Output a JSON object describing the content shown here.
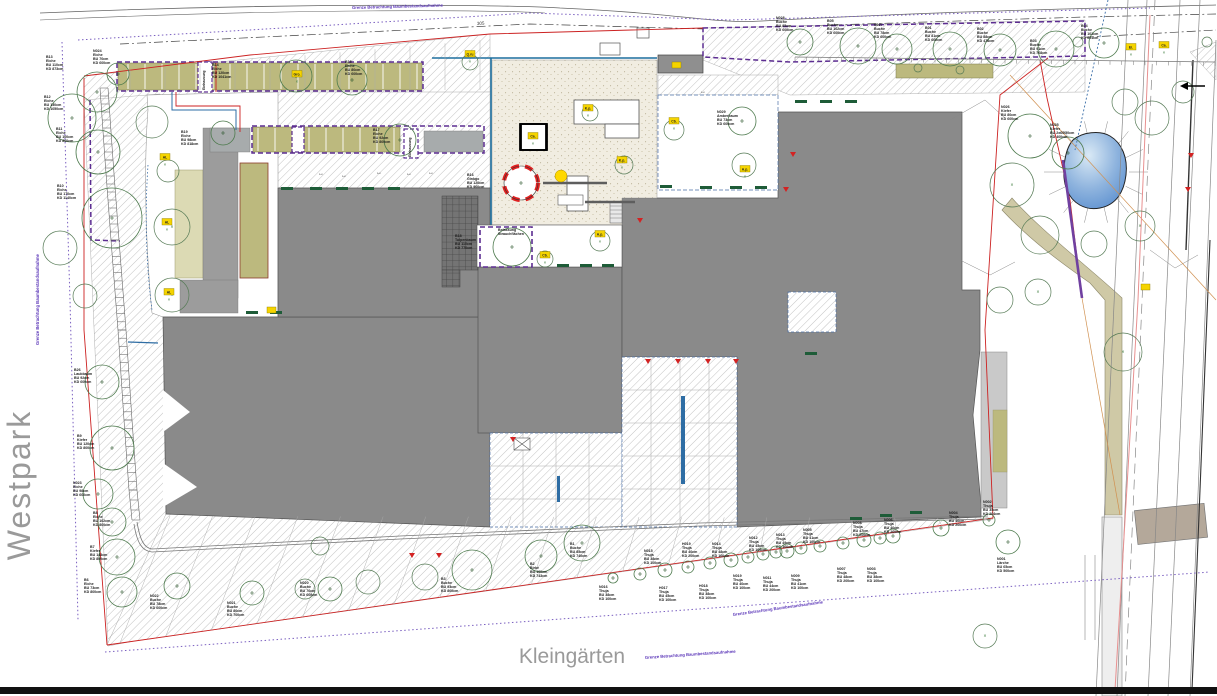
{
  "map_labels": {
    "westpark": "Westpark",
    "kleingaerten": "Kleingärten",
    "station_label": "305"
  },
  "boundary_notes": [
    {
      "text": "Grenze Betrachtung Baumbestandsaufnahme",
      "x": 352,
      "y": 9,
      "rot": -1.5
    },
    {
      "text": "Grenze Betrachtung Baumbestandsaufnahme",
      "x": 645,
      "y": 659,
      "rot": -4
    },
    {
      "text": "Grenze Betrachtung Baumbestandsaufnahme",
      "x": 733,
      "y": 616,
      "rot": -8
    },
    {
      "text": "Grenze Betrachtung Baumbestandsaufnahme",
      "x": 39,
      "y": 345,
      "rot": -90
    }
  ],
  "area_labels": [
    {
      "lines": [
        "Belassung",
        "Strauchflächen"
      ],
      "x": 498,
      "y": 230
    },
    {
      "lines": [
        "Einhausung"
      ],
      "x": 205,
      "y": 90,
      "vertical": true
    },
    {
      "lines": [
        "Einhausung"
      ],
      "x": 411,
      "y": 157,
      "vertical": true
    }
  ],
  "colors": {
    "building": "#8a8a8a",
    "building_light": "#c9c9c9",
    "planting": "#bcb97e",
    "planting_pale": "#dcdab4",
    "playground": "#f1ede1",
    "pond_light": "#cfe3f2",
    "pond_dark": "#5b8fcf",
    "boundary_purple": "#5c2d91",
    "boundary_red": "#cc2222",
    "tree_green": "#4d7a4d",
    "marker_yellow": "#f5d400",
    "path_beige": "#cfc9a6",
    "bar_green": "#1e5c38"
  },
  "trees": [
    {
      "id": "B13",
      "sp": "Eiche",
      "d1": "BU 110cm",
      "d2": "KD 873cm",
      "c": [
        97,
        92,
        20
      ],
      "l": [
        46,
        58
      ]
    },
    {
      "id": "N024",
      "sp": "Eiche",
      "d1": "BU 70cm",
      "d2": "KD 600cm",
      "c": [
        118,
        74,
        11
      ],
      "l": [
        93,
        52
      ]
    },
    {
      "id": "B12",
      "sp": "Eiche",
      "d1": "BU 130cm",
      "d2": "KD 1050cm",
      "c": [
        72,
        118,
        24
      ],
      "l": [
        44,
        98
      ]
    },
    {
      "id": "B11",
      "sp": "Eiche",
      "d1": "BU 100cm",
      "d2": "KD 800cm",
      "c": [
        98,
        152,
        22
      ],
      "l": [
        56,
        130
      ]
    },
    {
      "id": "B10",
      "sp": "Eiche",
      "d1": "BU 170cm",
      "d2": "KD 1140cm",
      "c": [
        112,
        218,
        30
      ],
      "l": [
        57,
        187
      ]
    },
    {
      "id": "B26",
      "sp": "Laubbaum",
      "d1": "BU 92cm",
      "d2": "KD 600cm",
      "c": [
        102,
        382,
        17
      ],
      "l": [
        74,
        371
      ]
    },
    {
      "id": "B9",
      "sp": "Kiefer",
      "d1": "BU 120cm",
      "d2": "KD 800cm",
      "c": [
        112,
        448,
        22
      ],
      "l": [
        77,
        437
      ]
    },
    {
      "id": "N023",
      "sp": "Eiche",
      "d1": "BU 98cm",
      "d2": "KD 600cm",
      "c": [
        98,
        494,
        15
      ],
      "l": [
        73,
        484
      ]
    },
    {
      "id": "B8",
      "sp": "Eiche",
      "d1": "BU 102cm",
      "d2": "KD 800cm",
      "c": [
        112,
        522,
        14
      ],
      "l": [
        93,
        514
      ]
    },
    {
      "id": "B7",
      "sp": "Kiefer",
      "d1": "BU 143cm",
      "d2": "KD 800cm",
      "c": [
        117,
        557,
        18
      ],
      "l": [
        90,
        548
      ]
    },
    {
      "id": "B6",
      "sp": "Eiche",
      "d1": "BU 73cm",
      "d2": "KD 800cm",
      "c": [
        122,
        592,
        15
      ],
      "l": [
        84,
        581
      ]
    },
    {
      "id": "N022",
      "sp": "Buche",
      "d1": "BU 78cm",
      "d2": "KD 600cm",
      "c": [
        177,
        586,
        13
      ],
      "l": [
        150,
        597
      ]
    },
    {
      "id": "N021",
      "sp": "Buche",
      "d1": "BU 80cm",
      "d2": "KD 700cm",
      "c": [
        252,
        593,
        12
      ],
      "l": [
        227,
        604
      ]
    },
    {
      "id": "N020",
      "sp": "Buche",
      "d1": "BU 76cm",
      "d2": "KD 600cm",
      "c": [
        330,
        589,
        12
      ],
      "l": [
        300,
        584
      ]
    },
    {
      "id": "B3",
      "sp": "Buche",
      "d1": "BU 93cm",
      "d2": "KD 800cm",
      "c": [
        472,
        570,
        20
      ],
      "l": [
        441,
        580
      ]
    },
    {
      "id": "B2",
      "sp": "Birke",
      "d1": "BU 100cm",
      "d2": "KD 743cm",
      "c": [
        541,
        556,
        16
      ],
      "l": [
        530,
        565
      ]
    },
    {
      "id": "B1",
      "sp": "Buche",
      "d1": "BU 85cm",
      "d2": "KD 740cm",
      "c": [
        582,
        543,
        18
      ],
      "l": [
        570,
        545
      ]
    },
    {
      "id": "B14",
      "sp": "Eiche",
      "d1": "BU 120cm",
      "d2": "KD 1041cm",
      "c": [
        296,
        76,
        16
      ],
      "l": [
        212,
        66
      ]
    },
    {
      "id": "B19",
      "sp": "Eiche",
      "d1": "BU 98cm",
      "d2": "KD 818cm",
      "c": [
        223,
        133,
        12
      ],
      "l": [
        181,
        133
      ]
    },
    {
      "id": "B15",
      "sp": "Eiche",
      "d1": "BU 80cm",
      "d2": "KD 600cm",
      "c": [
        352,
        80,
        15
      ],
      "l": [
        345,
        63
      ]
    },
    {
      "id": "B17",
      "sp": "Eiche",
      "d1": "BU 92cm",
      "d2": "KD 800cm",
      "c": [
        400,
        140,
        16
      ],
      "l": [
        373,
        131
      ]
    },
    {
      "id": "B16",
      "sp": "Ginkgo",
      "d1": "BU 120cm",
      "d2": "KD 900cm",
      "c": [
        521,
        183,
        17
      ],
      "l": [
        467,
        176
      ],
      "protected": true
    },
    {
      "id": "B18",
      "sp": "Tulpenbaum",
      "d1": "BU 110cm",
      "d2": "KD 770cm",
      "c": [
        512,
        247,
        19
      ],
      "l": [
        455,
        237
      ]
    },
    {
      "id": "N029",
      "sp": "Amberbaum",
      "d1": "BU 73cm",
      "d2": "KD 600cm",
      "c": [
        742,
        121,
        14
      ],
      "l": [
        717,
        113
      ]
    },
    {
      "id": "N028",
      "sp": "Buche",
      "d1": "BU 95cm",
      "d2": "KD 600cm",
      "c": [
        800,
        42,
        13
      ],
      "l": [
        776,
        19
      ]
    },
    {
      "id": "B05",
      "sp": "Buche",
      "d1": "BU 102cm",
      "d2": "KD 600cm",
      "c": [
        858,
        46,
        18
      ],
      "l": [
        827,
        22
      ]
    },
    {
      "id": "N027",
      "sp": "Buche",
      "d1": "BU 78cm",
      "d2": "KD 600cm",
      "c": [
        897,
        49,
        15
      ],
      "l": [
        874,
        26
      ]
    },
    {
      "id": "B01",
      "sp": "Buche",
      "d1": "BU 81cm",
      "d2": "KD 600cm",
      "c": [
        950,
        49,
        17
      ],
      "l": [
        925,
        29
      ]
    },
    {
      "id": "B02",
      "sp": "Buche",
      "d1": "BU 88cm",
      "d2": "KD 478cm",
      "c": [
        1000,
        50,
        16
      ],
      "l": [
        977,
        30
      ]
    },
    {
      "id": "B03",
      "sp": "Buche",
      "d1": "BU 91cm",
      "d2": "KD 768cm",
      "c": [
        1056,
        49,
        18
      ],
      "l": [
        1030,
        42
      ]
    },
    {
      "id": "B04",
      "sp": "Buche",
      "d1": "BU 101cm",
      "d2": "KD 601cm",
      "c": [
        1104,
        43,
        15
      ],
      "l": [
        1081,
        27
      ]
    },
    {
      "id": "N026",
      "sp": "Kiefer",
      "d1": "BU 80cm",
      "d2": "KD 600cm",
      "c": [
        1030,
        136,
        22
      ],
      "l": [
        1001,
        108
      ]
    },
    {
      "id": "N025",
      "sp": "Kiefer",
      "d1": "BU 2x60/50cm",
      "d2": "KD 400cm",
      "c": [
        1068,
        153,
        16
      ],
      "l": [
        1050,
        126
      ]
    },
    {
      "id": "N016",
      "sp": "Thuja",
      "d1": "BU 38cm",
      "d2": "KD 100cm",
      "c": [
        613,
        578,
        5
      ],
      "l": [
        599,
        588
      ]
    },
    {
      "id": "N015",
      "sp": "Thuja",
      "d1": "BU 38cm",
      "d2": "KD 100cm",
      "c": [
        640,
        574,
        6
      ],
      "l": [
        644,
        552
      ]
    },
    {
      "id": "H017",
      "sp": "Thuja",
      "d1": "BU 45cm",
      "d2": "KD 100cm",
      "c": [
        665,
        570,
        7
      ],
      "l": [
        659,
        589
      ]
    },
    {
      "id": "H019",
      "sp": "Thuja",
      "d1": "BU 40cm",
      "d2": "KD 200cm",
      "c": [
        688,
        567,
        6
      ],
      "l": [
        682,
        545
      ]
    },
    {
      "id": "H018",
      "sp": "Thuja",
      "d1": "BU 38cm",
      "d2": "KD 100cm",
      "c": [
        710,
        563,
        6
      ],
      "l": [
        699,
        587
      ]
    },
    {
      "id": "N014",
      "sp": "Thuja",
      "d1": "BU 48cm",
      "d2": "KD 100cm",
      "c": [
        731,
        560,
        7
      ],
      "l": [
        712,
        545
      ]
    },
    {
      "id": "N019",
      "sp": "Thuja",
      "d1": "BU 40cm",
      "d2": "KD 100cm",
      "c": [
        748,
        557,
        6
      ],
      "l": [
        733,
        577
      ]
    },
    {
      "id": "N012",
      "sp": "Thuja",
      "d1": "BU 45cm",
      "d2": "KD 100cm",
      "c": [
        763,
        554,
        6
      ],
      "l": [
        749,
        539
      ]
    },
    {
      "id": "N013",
      "sp": "Thuja",
      "d1": "BU 49cm",
      "d2": "KD 100cm",
      "c": [
        787,
        551,
        7
      ],
      "l": [
        776,
        536
      ]
    },
    {
      "id": "N011",
      "sp": "Thuja",
      "d1": "BU 44cm",
      "d2": "KD 200cm",
      "c": [
        776,
        552,
        6
      ],
      "l": [
        763,
        579
      ]
    },
    {
      "id": "N009",
      "sp": "Thuja",
      "d1": "BU 41cm",
      "d2": "KD 100cm",
      "c": [
        801,
        548,
        6
      ],
      "l": [
        791,
        577
      ]
    },
    {
      "id": "N005",
      "sp": "Thuja",
      "d1": "BU 41cm",
      "d2": "KD 100cm",
      "c": [
        820,
        546,
        6
      ],
      "l": [
        803,
        531
      ]
    },
    {
      "id": "N007",
      "sp": "Thuja",
      "d1": "BU 48cm",
      "d2": "KD 200cm",
      "c": [
        843,
        543,
        6
      ],
      "l": [
        837,
        570
      ]
    },
    {
      "id": "N008",
      "sp": "Thuja",
      "d1": "BU 47cm",
      "d2": "KD 200cm",
      "c": [
        864,
        540,
        7
      ],
      "l": [
        853,
        524
      ]
    },
    {
      "id": "N003",
      "sp": "Thuja",
      "d1": "BU 38cm",
      "d2": "KD 100cm",
      "c": [
        880,
        538,
        6
      ],
      "l": [
        867,
        570
      ]
    },
    {
      "id": "N006",
      "sp": "Thuja",
      "d1": "BU 40cm",
      "d2": "KD 200cm",
      "c": [
        893,
        536,
        7
      ],
      "l": [
        884,
        521
      ]
    },
    {
      "id": "N004",
      "sp": "Thuja",
      "d1": "BU 40cm",
      "d2": "KD 200cm",
      "c": [
        941,
        528,
        8
      ],
      "l": [
        949,
        514
      ]
    },
    {
      "id": "N002",
      "sp": "Thuja",
      "d1": "BU 35cm",
      "d2": "KD 204cm",
      "c": [
        989,
        520,
        6
      ],
      "l": [
        983,
        503
      ]
    },
    {
      "id": "N001",
      "sp": "Lärche",
      "d1": "BU 65cm",
      "d2": "KD 500cm",
      "c": [
        1008,
        542,
        12
      ],
      "l": [
        997,
        560
      ]
    }
  ],
  "unlabeled_tree_circles": [
    [
      60,
      248,
      17,
      ""
    ],
    [
      85,
      296,
      12,
      ""
    ],
    [
      152,
      122,
      16,
      ""
    ],
    [
      168,
      171,
      11,
      ""
    ],
    [
      172,
      227,
      18,
      "x"
    ],
    [
      172,
      295,
      17,
      "x"
    ],
    [
      320,
      546,
      9,
      ""
    ],
    [
      918,
      68,
      4,
      ""
    ],
    [
      960,
      70,
      4,
      ""
    ],
    [
      1078,
      42,
      5,
      ""
    ],
    [
      1207,
      42,
      5,
      ""
    ],
    [
      470,
      62,
      8,
      ""
    ],
    [
      545,
      259,
      8,
      ""
    ],
    [
      600,
      241,
      10,
      ""
    ],
    [
      674,
      130,
      10,
      ""
    ],
    [
      624,
      165,
      9,
      ""
    ],
    [
      590,
      113,
      8,
      ""
    ],
    [
      744,
      165,
      12,
      ""
    ],
    [
      1012,
      185,
      22,
      "x"
    ],
    [
      1040,
      235,
      19,
      ""
    ],
    [
      1094,
      244,
      13,
      ""
    ],
    [
      1140,
      226,
      15,
      "x"
    ],
    [
      1152,
      118,
      17,
      ""
    ],
    [
      1183,
      92,
      11,
      ""
    ],
    [
      1125,
      102,
      13,
      ""
    ],
    [
      1038,
      292,
      13,
      "x"
    ],
    [
      1123,
      352,
      19,
      "x"
    ],
    [
      1000,
      300,
      13,
      ""
    ],
    [
      985,
      636,
      12,
      "x"
    ],
    [
      305,
      589,
      10,
      ""
    ],
    [
      368,
      582,
      12,
      ""
    ],
    [
      425,
      577,
      13,
      ""
    ]
  ],
  "species_markers": [
    {
      "code": "Gro.",
      "x": 297,
      "y": 74
    },
    {
      "code": "Q.ru",
      "x": 470,
      "y": 54
    },
    {
      "code": "Ca.",
      "x": 533,
      "y": 136,
      "box": true
    },
    {
      "code": "K.p.",
      "x": 588,
      "y": 108
    },
    {
      "code": "K.p.",
      "x": 622,
      "y": 160
    },
    {
      "code": "Cb.",
      "x": 674,
      "y": 121
    },
    {
      "code": "A.p.",
      "x": 745,
      "y": 169
    },
    {
      "code": "A.p.",
      "x": 600,
      "y": 234
    },
    {
      "code": "Cb.",
      "x": 545,
      "y": 255
    },
    {
      "code": "AL",
      "x": 165,
      "y": 157
    },
    {
      "code": "AL",
      "x": 167,
      "y": 222
    },
    {
      "code": "AL",
      "x": 169,
      "y": 292
    },
    {
      "code": "Ei.",
      "x": 1131,
      "y": 47
    },
    {
      "code": "Ca.",
      "x": 1164,
      "y": 45
    }
  ],
  "symbols": {
    "red_triangles": [
      [
        637,
        218
      ],
      [
        783,
        187
      ],
      [
        790,
        152
      ],
      [
        645,
        359
      ],
      [
        675,
        359
      ],
      [
        705,
        359
      ],
      [
        733,
        359
      ],
      [
        510,
        437
      ],
      [
        409,
        553
      ],
      [
        436,
        553
      ],
      [
        1188,
        153
      ],
      [
        1185,
        187
      ]
    ],
    "green_bars": [
      [
        281,
        187
      ],
      [
        310,
        187
      ],
      [
        336,
        187
      ],
      [
        362,
        187
      ],
      [
        388,
        187
      ],
      [
        557,
        264
      ],
      [
        580,
        264
      ],
      [
        602,
        264
      ],
      [
        660,
        185
      ],
      [
        700,
        186
      ],
      [
        730,
        186
      ],
      [
        755,
        186
      ],
      [
        246,
        311
      ],
      [
        270,
        311
      ],
      [
        805,
        352
      ],
      [
        850,
        517
      ],
      [
        880,
        514
      ],
      [
        910,
        511
      ],
      [
        795,
        100
      ],
      [
        820,
        100
      ],
      [
        845,
        100
      ]
    ],
    "dim_arrows": [
      [
        318,
        175
      ],
      [
        341,
        177
      ],
      [
        376,
        174
      ],
      [
        406,
        175
      ],
      [
        428,
        174
      ],
      [
        700,
        93
      ]
    ],
    "yellow_squares": [
      [
        267,
        307
      ],
      [
        1141,
        284
      ],
      [
        672,
        62
      ]
    ]
  }
}
